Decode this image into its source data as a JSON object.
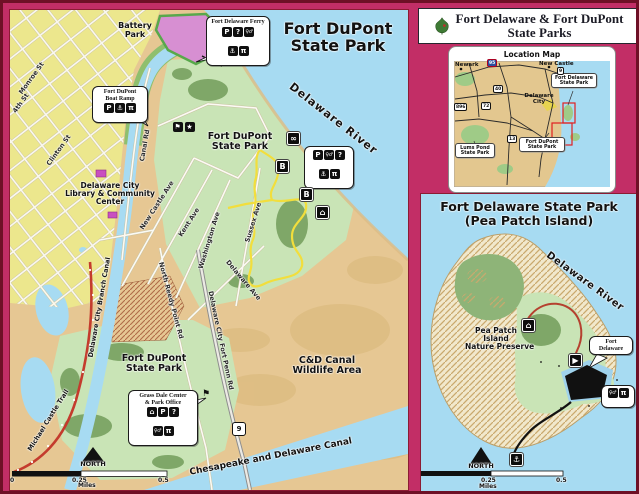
{
  "colors": {
    "frame_pink": "#c22e66",
    "water_blue": "#a7dbf2",
    "park_green": "#c9e4b6",
    "city_yellow": "#ece78d",
    "trail_yellow": "#f2de3c",
    "trail_red": "#c43b2d",
    "battery_pink": "#d78fd2",
    "highlight_red": "#e02020"
  },
  "header": {
    "line1": "Fort Delaware & Fort DuPont",
    "line2": "State Parks"
  },
  "location_map": {
    "title": "Location Map",
    "newark": "Newark",
    "new_castle": "New Castle",
    "delaware_city_l1": "Delaware",
    "delaware_city_l2": "City",
    "fort_delaware_l1": "Fort Delaware",
    "fort_delaware_l2": "State Park",
    "fort_dupont_l1": "Fort DuPont",
    "fort_dupont_l2": "State Park",
    "lums_pond_l1": "Lums Pond",
    "lums_pond_l2": "State Park",
    "shield_95": "95",
    "shield_40": "40",
    "shield_72": "72",
    "shield_896": "896",
    "shield_13": "13",
    "shield_9": "9"
  },
  "main_map": {
    "title_l1": "Fort DuPont",
    "title_l2": "State Park",
    "river": "Delaware River",
    "battery_l1": "Battery",
    "battery_l2": "Park",
    "ferry_callout": "Fort Delaware Ferry",
    "boat_ramp_l1": "Fort DuPont",
    "boat_ramp_l2": "Boat Ramp",
    "library_l1": "Delaware City",
    "library_l2": "Library & Community",
    "library_l3": "Center",
    "park1_l1": "Fort DuPont",
    "park1_l2": "State Park",
    "park2_l1": "Fort DuPont",
    "park2_l2": "State Park",
    "wildlife_l1": "C&D Canal",
    "wildlife_l2": "Wildlife Area",
    "grass_dale_l1": "Grass Dale Center",
    "grass_dale_l2": "& Park Office",
    "branch_canal": "Delaware City Branch Canal",
    "cd_canal": "Chesapeake and Delaware Canal",
    "trail_name": "Michael Castle Trail",
    "streets": {
      "monroe": "Monroe St",
      "fourth": "4th St",
      "clinton": "Clinton St",
      "canal_rd": "Canal Rd",
      "new_castle": "New Castle Ave",
      "kent": "Kent Ave",
      "washington": "Washington Ave",
      "sussex": "Sussex Ave",
      "delaware": "Delaware Ave",
      "north_reedy": "North Reedy Point Rd",
      "fort_penn": "Delaware City Fort Penn Rd"
    },
    "marker_b": "B",
    "route9": "9",
    "north": "NORTH",
    "scale_0": "0",
    "scale_quarter": "0.25",
    "scale_half": "0.5",
    "scale_unit": "Miles"
  },
  "pea_patch": {
    "title_l1": "Fort Delaware State Park",
    "title_l2": "(Pea Patch Island)",
    "river": "Delaware River",
    "preserve_l1": "Pea Patch",
    "preserve_l2": "Island",
    "preserve_l3": "Nature Preserve",
    "fort_l1": "Fort",
    "fort_l2": "Delaware",
    "north": "NORTH",
    "scale_quarter": "0.25",
    "scale_half": "0.5",
    "scale_unit": "Miles"
  },
  "icons": {
    "parking": "P",
    "question": "?",
    "restroom": "♀♂",
    "picnic": "π",
    "anchor": "⚓",
    "home": "⌂",
    "flag": "⚑",
    "star": "★",
    "wildlife": "∞",
    "viewing": "▶"
  }
}
